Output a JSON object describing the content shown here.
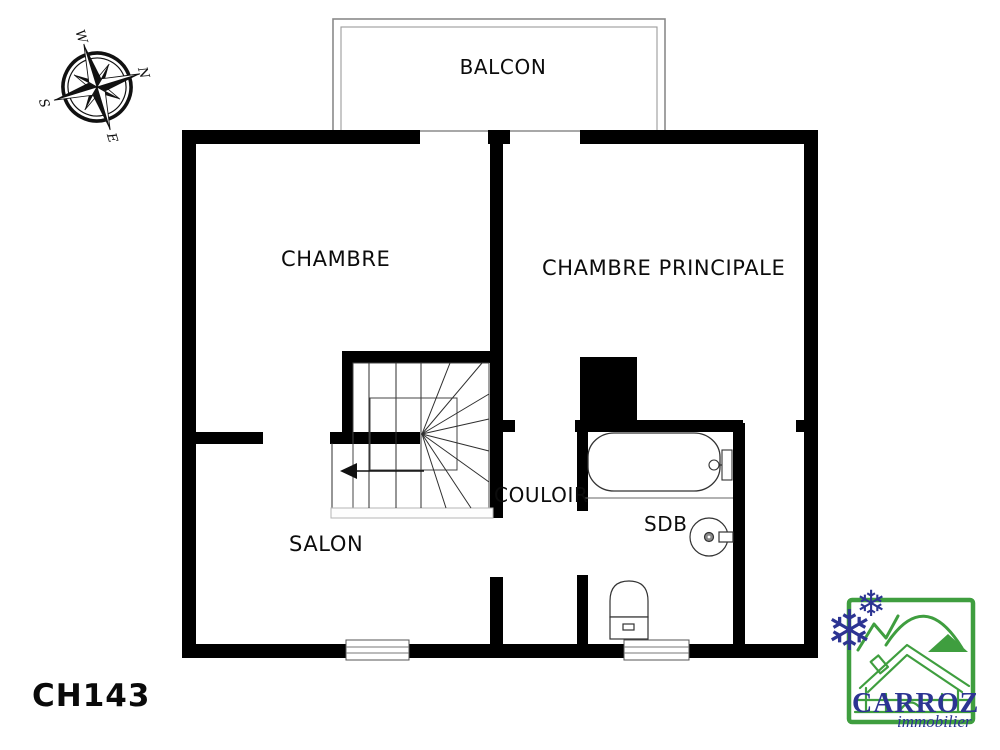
{
  "reference": "CH143",
  "rooms": {
    "balcon": "BALCON",
    "chambre": "CHAMBRE",
    "chambre_principale": "CHAMBRE PRINCIPALE",
    "couloir": "COULOIR",
    "sdb": "SDB",
    "salon": "SALON"
  },
  "compass": {
    "n": "N",
    "e": "E",
    "s": "S",
    "w": "W"
  },
  "logo": {
    "brand": "CARROZ",
    "tagline": "immobilier"
  },
  "colors": {
    "wall": "#000000",
    "background": "#ffffff",
    "fixture_stroke": "#333333",
    "logo_green": "#3f9e3f",
    "logo_blue": "#2c3492"
  }
}
